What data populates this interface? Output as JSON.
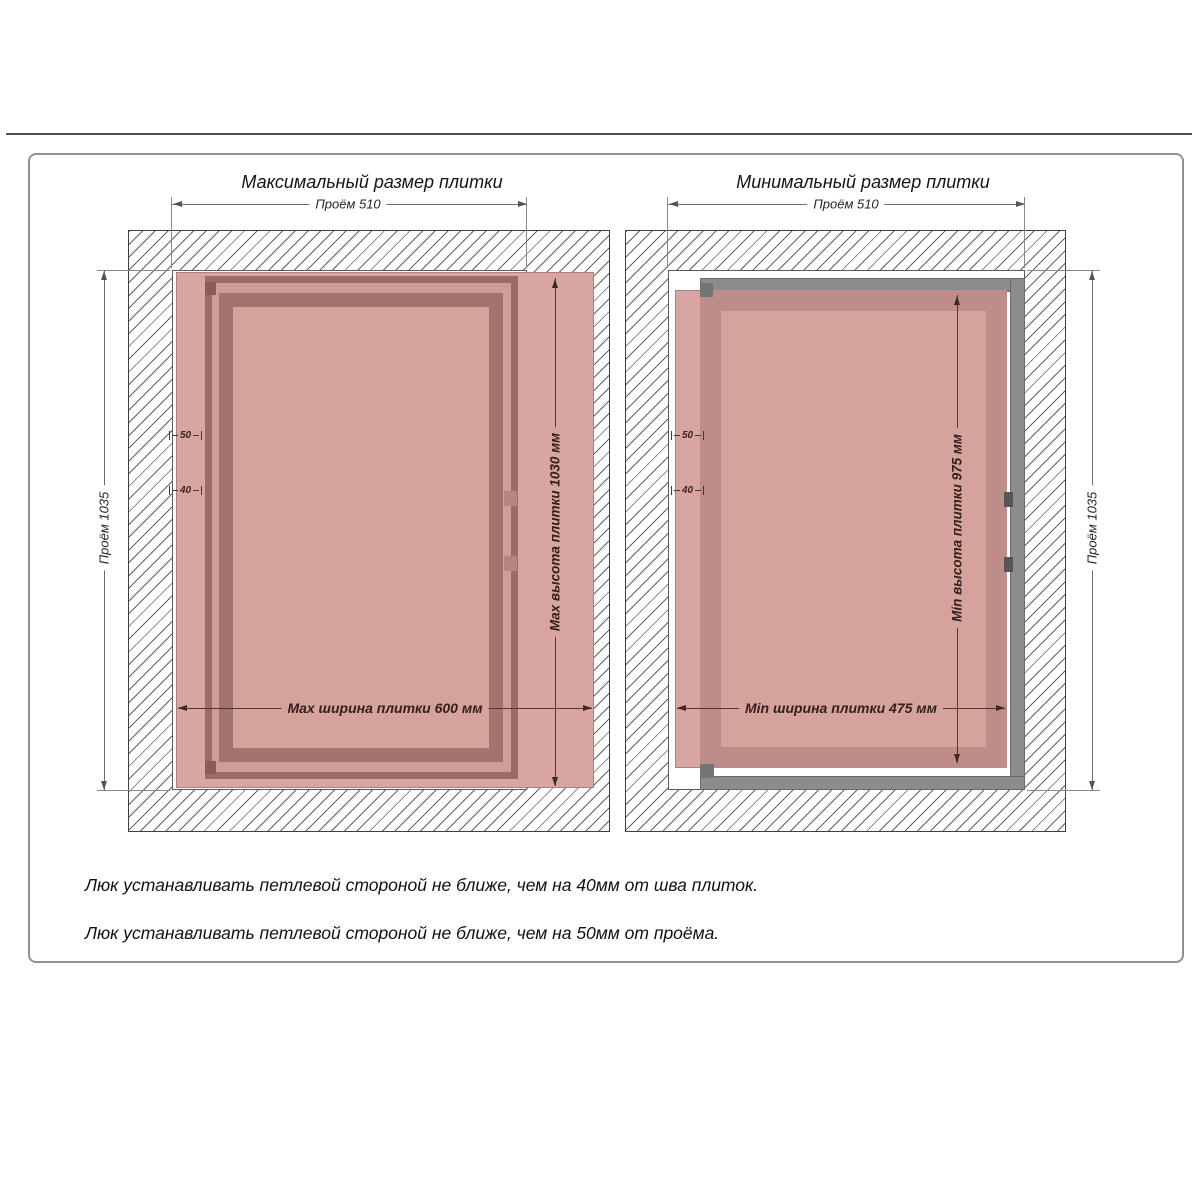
{
  "colors": {
    "tile": "#d9a5a2",
    "panel": "#d5a29c",
    "frame-dark": "#9c6a67",
    "frame-mid": "#cf9c99",
    "frame-inner": "#a27370",
    "min-band": "#bf8d89",
    "steel": "#8c8c8c",
    "border": "#909090",
    "rule": "#4f4f4f",
    "text": "#151515"
  },
  "left": {
    "title": "Максимальный размер плитки",
    "dims": {
      "opening_width": "Проём 510",
      "opening_height": "Проём 1035",
      "tile_height": "Max высота плитки 1030 мм",
      "tile_width": "Max ширина плитки 600 мм",
      "offset_opening": "50",
      "offset_seam": "40"
    }
  },
  "right": {
    "title": "Минимальный размер плитки",
    "dims": {
      "opening_width": "Проём 510",
      "opening_height": "Проём 1035",
      "tile_height": "Min высота плитки 975 мм",
      "tile_width": "Min ширина плитки 475 мм",
      "offset_opening": "50",
      "offset_seam": "40"
    }
  },
  "notes": [
    "Люк устанавливать петлевой стороной не ближе, чем на 40мм от шва плиток.",
    "Люк устанавливать петлевой стороной не ближе, чем на 50мм от проёма."
  ]
}
